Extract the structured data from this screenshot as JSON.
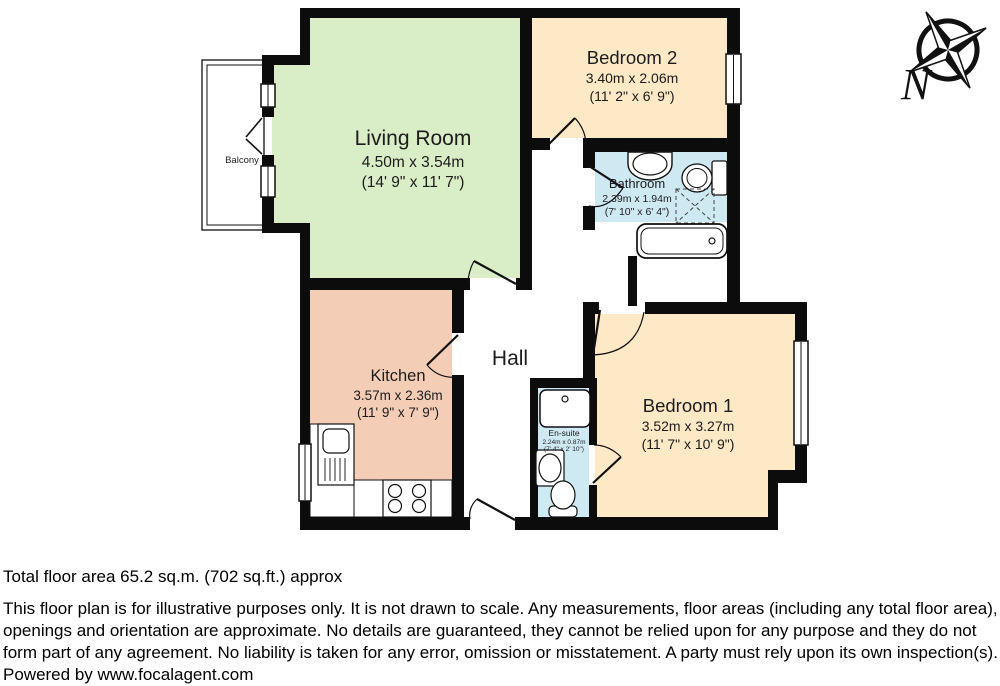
{
  "plan": {
    "rooms": [
      {
        "name": "Living Room",
        "metric": "4.50m x 3.54m",
        "imperial": "(14' 9\" x 11' 7\")"
      },
      {
        "name": "Bedroom 2",
        "metric": "3.40m x 2.06m",
        "imperial": "(11' 2\" x 6' 9\")"
      },
      {
        "name": "Bathroom",
        "metric": "2.39m x 1.94m",
        "imperial": "(7' 10\" x 6' 4\")"
      },
      {
        "name": "Kitchen",
        "metric": "3.57m x 2.36m",
        "imperial": "(11' 9\" x 7' 9\")"
      },
      {
        "name": "Hall"
      },
      {
        "name": "Bedroom 1",
        "metric": "3.52m x 3.27m",
        "imperial": "(11' 7\" x 10' 9\")"
      },
      {
        "name": "En-suite",
        "metric": "2.24m x 0.87m",
        "imperial": "(7' 4\" x 2' 10\")"
      },
      {
        "name": "Balcony"
      }
    ],
    "compass": {
      "north_label": "N"
    },
    "colors": {
      "living_room": "#d9edc6",
      "bedroom": "#fde9c6",
      "kitchen": "#f4cdb6",
      "bathroom": "#cfe9f3",
      "wall": "#0c0c0c"
    },
    "fixture_icons": [
      "compass-rose-icon",
      "bathtub-icon",
      "toilet-icon",
      "wash-basin-icon",
      "shower-tray-icon",
      "airing-cupboard-icon",
      "kitchen-sink-icon",
      "hob-icon",
      "window-icon",
      "door-swing-icon"
    ]
  },
  "footer": {
    "total_area": "Total floor area 65.2 sq.m. (702 sq.ft.) approx",
    "disclaimer": "This floor plan is for illustrative purposes only. It is not drawn to scale. Any measurements, floor areas (including any total floor area), openings and orientation are approximate. No details are guaranteed, they cannot be relied upon for any purpose and they do not form part of any agreement. No liability is taken for any error, omission or misstatement. A party must rely upon its own inspection(s).",
    "powered_by": "Powered by www.focalagent.com"
  }
}
